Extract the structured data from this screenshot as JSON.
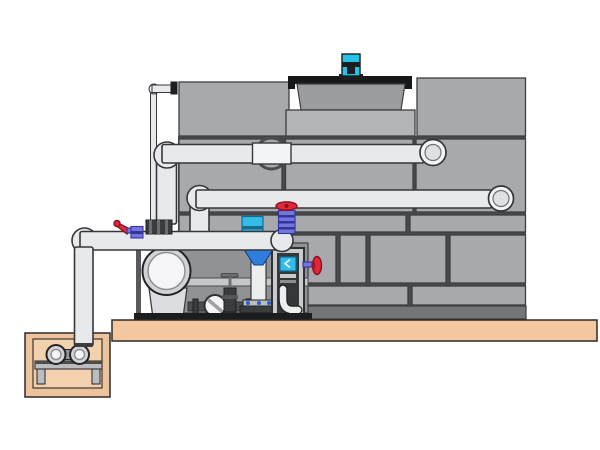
{
  "scene": {
    "type": "technical-illustration",
    "subject": "cooling tower with circulation pump skid and sump pit",
    "visible_text": []
  },
  "components": [
    "cooling-tower-casing",
    "fan-motor",
    "fan-shroud",
    "hot-water-return-pipe",
    "spray-distribution-pipe",
    "suction-header-pipe",
    "makeup-water-line",
    "circulation-pump",
    "sight-glass",
    "chemical-injector",
    "control-cabinet",
    "red-handwheel-valve",
    "red-lever-valve",
    "gate-valves",
    "dosing-box",
    "concrete-platform",
    "sump-pit",
    "sump-pump",
    "pump-stand"
  ],
  "colors": {
    "background": "#ffffff",
    "panel": "#a7a9ac",
    "panelLight": "#b2b4b7",
    "panelStroke": "#3c3e41",
    "seam": "#47494c",
    "towerBase": "#737578",
    "shroud": "#9a9c9f",
    "rimDark": "#17181a",
    "motorCyan": "#25c2e8",
    "pipe": "#e8e9eb",
    "pipeSleeve": "#f3f4f5",
    "pipeStroke": "#35373a",
    "elbowInner": "#dfe0e2",
    "dark": "#1c1d1f",
    "metal": "#bcbdbf",
    "metalDark": "#4a4c50",
    "outline": "#232425",
    "valvePurple": "#7577d8",
    "valvePurpleDark": "#3234a0",
    "red": "#e02838",
    "redDark": "#8a1220",
    "blue": "#2f7ddc",
    "blueDark": "#16407e",
    "cyanBox": "#35bce4",
    "cyanDark": "#0c6e98",
    "skidPanel": "#909295",
    "rail": "#c6c7c9",
    "pumpOuter": "#d2d3d6",
    "pumpInner": "#f5f5f7",
    "pumpBody": "#dcdde0",
    "panelFrame": "#c9cacc",
    "panelInterior": "#35373b",
    "whitePart": "#eceded",
    "platform": "#f4c79e",
    "pit": "#eec29a",
    "pitInner": "#f3d0ae",
    "groundStroke": "#2b2b2b"
  }
}
